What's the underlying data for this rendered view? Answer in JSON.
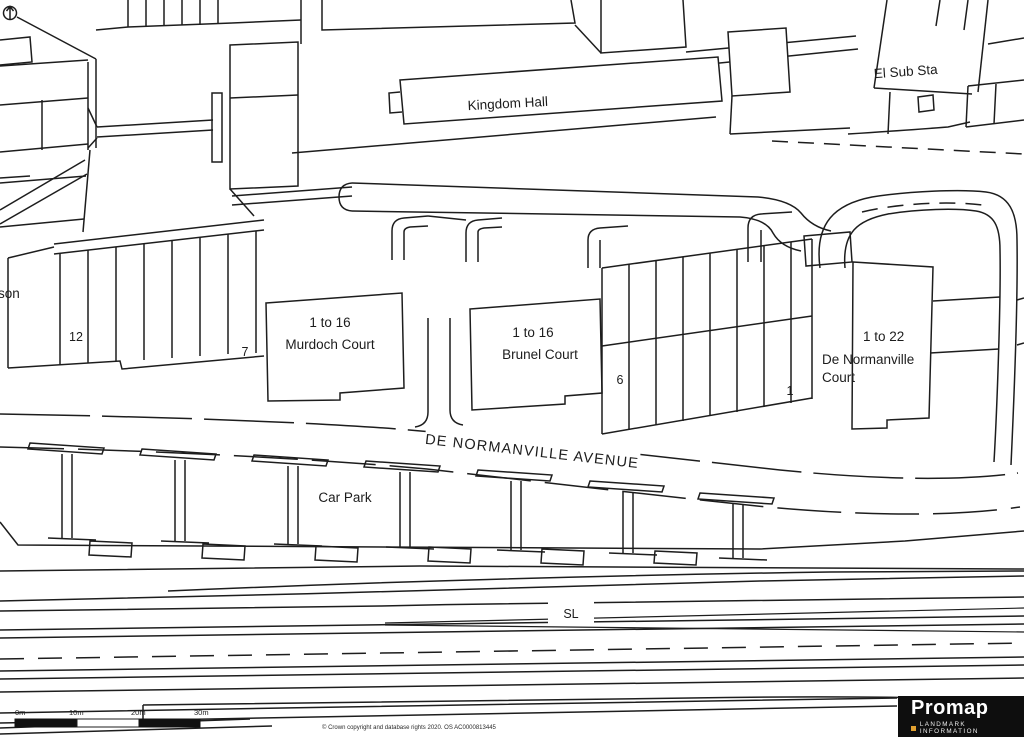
{
  "map": {
    "bg_color": "#FFFFFF",
    "line_color": "#1D1D1D",
    "labels": {
      "el_sub_sta": "El Sub Sta",
      "kingdom_hall": "Kingdom Hall",
      "son": "son",
      "plot_12": "12",
      "plot_7": "7",
      "murdoch_range": "1 to 16",
      "murdoch_name": "Murdoch Court",
      "brunel_range": "1 to 16",
      "brunel_name": "Brunel Court",
      "plot_6": "6",
      "plot_1": "1",
      "dnc_range": "1 to 22",
      "dnc_name_line1": "De Normanville",
      "dnc_name_line2": "Court",
      "avenue": "DE NORMANVILLE AVENUE",
      "car_park": "Car Park",
      "sl": "SL"
    },
    "scale_bar": {
      "labels": [
        "0m",
        "10m",
        "20m",
        "30m"
      ]
    },
    "footer": {
      "copyright": "© Crown copyright and database rights 2020. OS AC0000813445"
    },
    "branding": {
      "name": "Promap",
      "tagline": "LANDMARK INFORMATION",
      "accent_color": "#E0A030",
      "bg_color": "#0E0E0E",
      "text_color": "#FFFFFF"
    }
  }
}
